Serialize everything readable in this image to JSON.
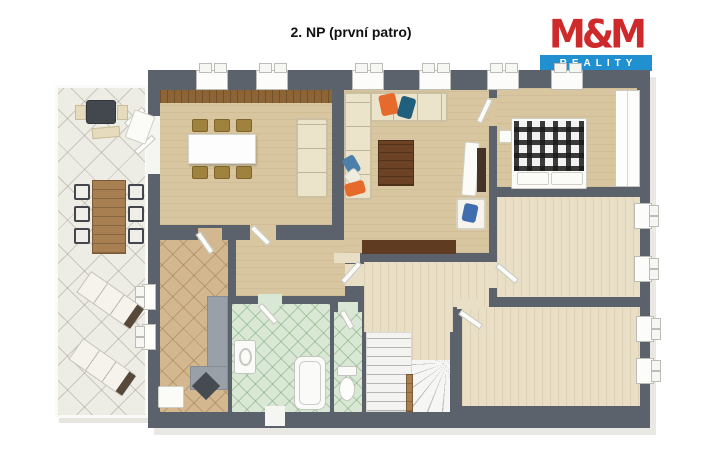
{
  "header": {
    "title": "2. NP (první patro)"
  },
  "logo": {
    "brand": "M&M",
    "tagline": "REALITY",
    "brand_color": "#ce2a2c",
    "tagline_bg": "#2090d0"
  },
  "colors": {
    "wall": "#5c626b",
    "floor_beige": "#d8c6a0",
    "floor_wood": "#e9dfc6",
    "tile_terrace": "#edece5",
    "tile_entry": "#d3b88f",
    "tile_bath": "#d9e8d4",
    "accent_wood": "#8d6435"
  },
  "plan": {
    "elements": [
      {
        "name": "terrace-deck",
        "c": "terrace",
        "x": 55,
        "y": 85,
        "w": 93,
        "h": 333
      },
      {
        "name": "building-shell",
        "c": "wall",
        "x": 148,
        "y": 70,
        "w": 502,
        "h": 358
      },
      {
        "name": "dining-room-floor",
        "c": "floor-beige",
        "x": 160,
        "y": 90,
        "w": 172,
        "h": 135
      },
      {
        "name": "dining-sideboard-strip",
        "c": "wood-strip",
        "x": 160,
        "y": 90,
        "w": 172,
        "h": 13
      },
      {
        "name": "living-room-floor",
        "c": "floor-beige",
        "x": 344,
        "y": 90,
        "w": 145,
        "h": 163
      },
      {
        "name": "bedroom-floor",
        "c": "floor-beige",
        "x": 497,
        "y": 88,
        "w": 140,
        "h": 99
      },
      {
        "name": "hall-floor",
        "c": "floor-beige",
        "x": 236,
        "y": 240,
        "w": 109,
        "h": 56
      },
      {
        "name": "corridor-floor",
        "c": "floor-wood",
        "x": 364,
        "y": 262,
        "w": 125,
        "h": 70
      },
      {
        "name": "room-midright-floor",
        "c": "floor-wood",
        "x": 497,
        "y": 197,
        "w": 143,
        "h": 100
      },
      {
        "name": "room-bottomright-floor",
        "c": "floor-wood",
        "x": 462,
        "y": 307,
        "w": 178,
        "h": 99
      },
      {
        "name": "entry-hall-floor",
        "c": "tile-entry",
        "x": 160,
        "y": 240,
        "w": 68,
        "h": 172
      },
      {
        "name": "bathroom-floor",
        "c": "tile-bath",
        "x": 232,
        "y": 304,
        "w": 98,
        "h": 108
      },
      {
        "name": "wc-floor",
        "c": "tile-bath",
        "x": 334,
        "y": 312,
        "w": 28,
        "h": 100
      },
      {
        "name": "stairs-straight-flight",
        "c": "stairs-straight",
        "x": 366,
        "y": 332,
        "w": 46,
        "h": 80
      },
      {
        "name": "stairs-winder-fan",
        "c": "stairs-fan",
        "x": 412,
        "y": 360,
        "w": 38,
        "h": 52
      },
      {
        "name": "stairs-landing",
        "c": "floor-wood",
        "x": 412,
        "y": 332,
        "w": 38,
        "h": 28
      },
      {
        "name": "stairs-banister",
        "c": "table-wood",
        "x": 406,
        "y": 374,
        "w": 7,
        "h": 38
      },
      {
        "name": "stairs-separator-wall",
        "c": "wall-stub",
        "x": 453,
        "y": 307,
        "w": 9,
        "h": 26
      },
      {
        "name": "terrace-door-opening",
        "c": "gap-white",
        "x": 146,
        "y": 116,
        "w": 14,
        "h": 58
      },
      {
        "name": "dining-hall-opening",
        "c": "gap-beige",
        "x": 250,
        "y": 225,
        "w": 26,
        "h": 16
      },
      {
        "name": "entry-door-opening",
        "c": "gap-tan",
        "x": 198,
        "y": 228,
        "w": 24,
        "h": 13
      },
      {
        "name": "hall-corridor-opening",
        "c": "gap-wood",
        "x": 345,
        "y": 264,
        "w": 19,
        "h": 22
      },
      {
        "name": "living-door-opening",
        "c": "gap-wood",
        "x": 334,
        "y": 253,
        "w": 26,
        "h": 10
      },
      {
        "name": "bedroom-door-opening",
        "c": "gap-beige",
        "x": 489,
        "y": 98,
        "w": 8,
        "h": 28
      },
      {
        "name": "midright-door-opening",
        "c": "gap-wood",
        "x": 489,
        "y": 262,
        "w": 8,
        "h": 26
      },
      {
        "name": "bottomright-door-opening",
        "c": "gap-wood",
        "x": 457,
        "y": 299,
        "w": 26,
        "h": 10
      },
      {
        "name": "bathroom-door-opening",
        "c": "gap-green",
        "x": 258,
        "y": 294,
        "w": 24,
        "h": 12
      },
      {
        "name": "wc-door-opening",
        "c": "gap-green",
        "x": 338,
        "y": 302,
        "w": 20,
        "h": 12
      },
      {
        "name": "bathroom-window",
        "c": "gap-white",
        "x": 265,
        "y": 406,
        "w": 20,
        "h": 20
      },
      {
        "name": "window-top-1",
        "c": "window-top",
        "x": 196,
        "y": 70,
        "w": 32,
        "h": 20
      },
      {
        "name": "window-top-2",
        "c": "window-top",
        "x": 256,
        "y": 70,
        "w": 32,
        "h": 20
      },
      {
        "name": "window-top-3",
        "c": "window-top",
        "x": 352,
        "y": 70,
        "w": 32,
        "h": 20
      },
      {
        "name": "window-top-4",
        "c": "window-top",
        "x": 419,
        "y": 70,
        "w": 32,
        "h": 20
      },
      {
        "name": "window-top-5",
        "c": "window-top",
        "x": 487,
        "y": 70,
        "w": 32,
        "h": 20
      },
      {
        "name": "window-top-6",
        "c": "window-top",
        "x": 551,
        "y": 70,
        "w": 32,
        "h": 20
      },
      {
        "name": "window-right-1",
        "c": "window-right",
        "x": 634,
        "y": 203,
        "w": 18,
        "h": 26
      },
      {
        "name": "window-right-2",
        "c": "window-right",
        "x": 634,
        "y": 256,
        "w": 18,
        "h": 26
      },
      {
        "name": "window-right-3",
        "c": "window-right",
        "x": 636,
        "y": 316,
        "w": 18,
        "h": 26
      },
      {
        "name": "window-right-4",
        "c": "window-right",
        "x": 636,
        "y": 358,
        "w": 18,
        "h": 26
      },
      {
        "name": "entry-window-1",
        "c": "window-left",
        "x": 142,
        "y": 284,
        "w": 14,
        "h": 26
      },
      {
        "name": "entry-window-2",
        "c": "window-left",
        "x": 142,
        "y": 324,
        "w": 14,
        "h": 26
      },
      {
        "name": "terrace-door-leaf-1",
        "c": "door-leaf",
        "x": 126,
        "y": 122,
        "w": 24,
        "h": 6,
        "r": -42
      },
      {
        "name": "terrace-door-leaf-2",
        "c": "door-leaf",
        "x": 136,
        "y": 150,
        "w": 24,
        "h": 6,
        "r": -42
      },
      {
        "name": "dining-door-leaf",
        "c": "door-leaf",
        "x": 252,
        "y": 224,
        "w": 24,
        "h": 6,
        "r": 45
      },
      {
        "name": "entry-door-leaf",
        "c": "door-leaf",
        "x": 198,
        "y": 230,
        "w": 24,
        "h": 6,
        "r": 55
      },
      {
        "name": "living-door-leaf",
        "c": "door-leaf",
        "x": 360,
        "y": 260,
        "w": 26,
        "h": 6,
        "r": 132
      },
      {
        "name": "bedroom-door-leaf",
        "c": "door-leaf",
        "x": 490,
        "y": 96,
        "w": 26,
        "h": 6,
        "r": 115
      },
      {
        "name": "midright-door-leaf",
        "c": "door-leaf",
        "x": 497,
        "y": 262,
        "w": 26,
        "h": 6,
        "r": 40
      },
      {
        "name": "bottomright-door-leaf",
        "c": "door-leaf",
        "x": 460,
        "y": 309,
        "w": 26,
        "h": 6,
        "r": 35
      },
      {
        "name": "bathroom-door-leaf",
        "c": "door-leaf",
        "x": 260,
        "y": 302,
        "w": 24,
        "h": 6,
        "r": 48
      },
      {
        "name": "wc-door-leaf",
        "c": "door-leaf",
        "x": 342,
        "y": 308,
        "w": 20,
        "h": 6,
        "r": 60
      },
      {
        "name": "grill-shelf-left",
        "c": "shelf-beige",
        "x": 75,
        "y": 105,
        "w": 11,
        "h": 15
      },
      {
        "name": "grill-shelf-right",
        "c": "shelf-beige",
        "x": 117,
        "y": 105,
        "w": 11,
        "h": 15
      },
      {
        "name": "grill",
        "c": "grill",
        "x": 86,
        "y": 100,
        "w": 30,
        "h": 24
      },
      {
        "name": "grill-tray",
        "c": "shelf-beige",
        "x": 92,
        "y": 127,
        "w": 28,
        "h": 11,
        "r": -5
      },
      {
        "name": "folded-patio-chair",
        "c": "white-item",
        "x": 129,
        "y": 112,
        "w": 22,
        "h": 30,
        "r": 20
      },
      {
        "name": "patio-table",
        "c": "table-wood",
        "x": 92,
        "y": 180,
        "w": 34,
        "h": 74
      },
      {
        "name": "patio-chair-1",
        "c": "chair-patio",
        "x": 74,
        "y": 184,
        "w": 16,
        "h": 16
      },
      {
        "name": "patio-chair-2",
        "c": "chair-patio",
        "x": 74,
        "y": 206,
        "w": 16,
        "h": 16
      },
      {
        "name": "patio-chair-3",
        "c": "chair-patio",
        "x": 74,
        "y": 228,
        "w": 16,
        "h": 16
      },
      {
        "name": "patio-chair-4",
        "c": "chair-patio",
        "x": 128,
        "y": 184,
        "w": 16,
        "h": 16
      },
      {
        "name": "patio-chair-5",
        "c": "chair-patio",
        "x": 128,
        "y": 206,
        "w": 16,
        "h": 16
      },
      {
        "name": "patio-chair-6",
        "c": "chair-patio",
        "x": 128,
        "y": 228,
        "w": 16,
        "h": 16
      },
      {
        "name": "sun-lounger-1",
        "c": "lounger",
        "x": 78,
        "y": 287,
        "w": 64,
        "h": 26,
        "r": 35
      },
      {
        "name": "sun-lounger-2",
        "c": "lounger",
        "x": 70,
        "y": 354,
        "w": 64,
        "h": 26,
        "r": 35
      },
      {
        "name": "dining-table",
        "c": "table-white",
        "x": 188,
        "y": 134,
        "w": 68,
        "h": 30
      },
      {
        "name": "dining-chair-1",
        "c": "chair-brown",
        "x": 192,
        "y": 119,
        "w": 16,
        "h": 13
      },
      {
        "name": "dining-chair-2",
        "c": "chair-brown",
        "x": 214,
        "y": 119,
        "w": 16,
        "h": 13
      },
      {
        "name": "dining-chair-3",
        "c": "chair-brown",
        "x": 236,
        "y": 119,
        "w": 16,
        "h": 13
      },
      {
        "name": "dining-chair-4",
        "c": "chair-brown",
        "x": 192,
        "y": 166,
        "w": 16,
        "h": 13
      },
      {
        "name": "dining-chair-5",
        "c": "chair-brown",
        "x": 214,
        "y": 166,
        "w": 16,
        "h": 13
      },
      {
        "name": "dining-chair-6",
        "c": "chair-brown",
        "x": 236,
        "y": 166,
        "w": 16,
        "h": 13
      },
      {
        "name": "dining-sofa",
        "c": "sofa sofa-v",
        "x": 296,
        "y": 118,
        "w": 32,
        "h": 80
      },
      {
        "name": "corner-sofa-top",
        "c": "sofa sofa-h",
        "x": 344,
        "y": 92,
        "w": 104,
        "h": 30
      },
      {
        "name": "corner-sofa-left",
        "c": "sofa sofa-v",
        "x": 344,
        "y": 92,
        "w": 28,
        "h": 108
      },
      {
        "name": "sofa-pillow-orange",
        "c": "pillow-o",
        "x": 380,
        "y": 94,
        "w": 17,
        "h": 21,
        "r": -12
      },
      {
        "name": "sofa-pillow-teal",
        "c": "pillow-t",
        "x": 399,
        "y": 97,
        "w": 15,
        "h": 21,
        "r": 16
      },
      {
        "name": "sofa-pillow-blue",
        "c": "pillow-b",
        "x": 345,
        "y": 156,
        "w": 13,
        "h": 18,
        "r": -30
      },
      {
        "name": "sofa-pillow-white",
        "c": "pillow-w",
        "x": 346,
        "y": 170,
        "w": 14,
        "h": 14,
        "r": -40
      },
      {
        "name": "sofa-pillow-orange-2",
        "c": "pillow-o",
        "x": 345,
        "y": 182,
        "w": 20,
        "h": 13,
        "r": -15
      },
      {
        "name": "coffee-table",
        "c": "coffee",
        "x": 378,
        "y": 140,
        "w": 36,
        "h": 46
      },
      {
        "name": "tv-stand",
        "c": "white-item",
        "x": 463,
        "y": 142,
        "w": 15,
        "h": 54,
        "r": 4
      },
      {
        "name": "tv",
        "c": "tv",
        "x": 477,
        "y": 148,
        "w": 9,
        "h": 44
      },
      {
        "name": "armchair",
        "c": "armchair",
        "x": 456,
        "y": 198,
        "w": 30,
        "h": 32
      },
      {
        "name": "armchair-pillow",
        "c": "pillow-db",
        "x": 463,
        "y": 204,
        "w": 14,
        "h": 18,
        "r": 12
      },
      {
        "name": "media-sideboard",
        "c": "sideboard",
        "x": 362,
        "y": 240,
        "w": 94,
        "h": 14
      },
      {
        "name": "bed-frame",
        "c": "white-item",
        "x": 511,
        "y": 118,
        "w": 76,
        "h": 71
      },
      {
        "name": "bed-plaid-blanket",
        "c": "plaid",
        "x": 514,
        "y": 121,
        "w": 70,
        "h": 50
      },
      {
        "name": "bed-pillow-1",
        "c": "white-item",
        "x": 517,
        "y": 172,
        "w": 32,
        "h": 13
      },
      {
        "name": "bed-pillow-2",
        "c": "white-item",
        "x": 551,
        "y": 172,
        "w": 32,
        "h": 13
      },
      {
        "name": "nightstand",
        "c": "white-item",
        "x": 499,
        "y": 130,
        "w": 13,
        "h": 13
      },
      {
        "name": "wardrobe",
        "c": "wardrobe",
        "x": 615,
        "y": 90,
        "w": 25,
        "h": 97
      },
      {
        "name": "entry-counter-vertical",
        "c": "counter-gray",
        "x": 207,
        "y": 296,
        "w": 21,
        "h": 92
      },
      {
        "name": "entry-counter-horizontal",
        "c": "counter-gray",
        "x": 190,
        "y": 366,
        "w": 38,
        "h": 24
      },
      {
        "name": "entry-floor-mat-dark",
        "c": "mat-dark",
        "x": 196,
        "y": 376,
        "w": 20,
        "h": 20,
        "r": 45
      },
      {
        "name": "entry-doormat",
        "c": "white-item",
        "x": 158,
        "y": 386,
        "w": 26,
        "h": 22
      },
      {
        "name": "bathroom-sink",
        "c": "sink",
        "x": 234,
        "y": 340,
        "w": 22,
        "h": 34
      },
      {
        "name": "bathtub",
        "c": "tub",
        "x": 294,
        "y": 356,
        "w": 32,
        "h": 54
      },
      {
        "name": "wc-cistern",
        "c": "wc-cistern",
        "x": 337,
        "y": 366,
        "w": 20,
        "h": 10
      },
      {
        "name": "wc-bowl",
        "c": "wc-bowl",
        "x": 339,
        "y": 377,
        "w": 16,
        "h": 24
      }
    ]
  }
}
